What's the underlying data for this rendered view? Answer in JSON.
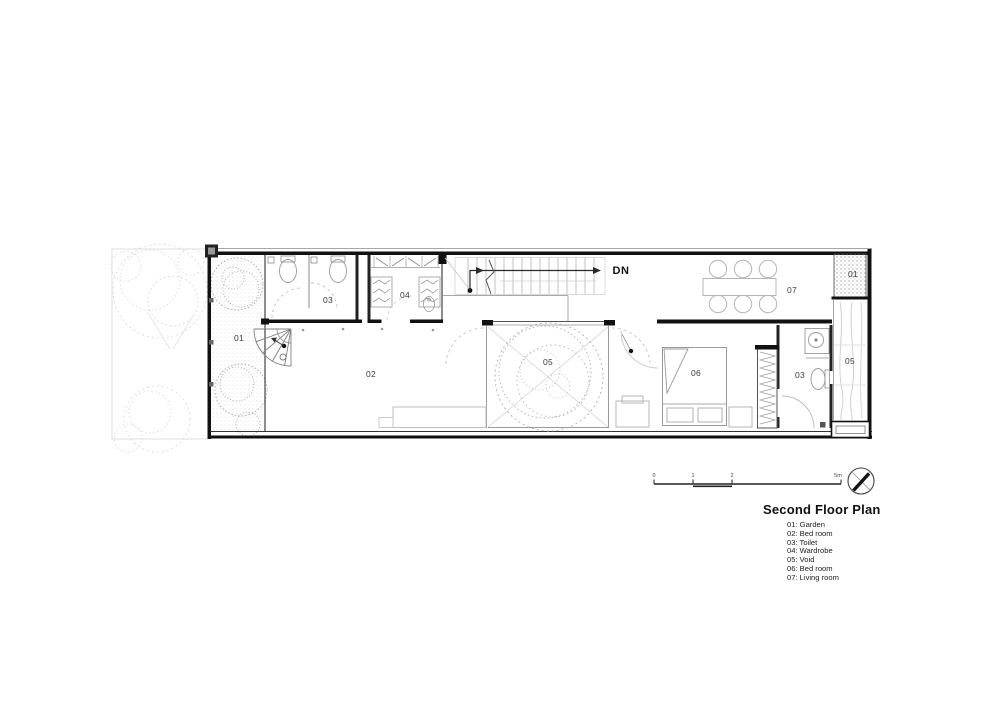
{
  "plan": {
    "dn_label": "DN",
    "labels": {
      "garden_left": "01",
      "bedroom_main": "02",
      "toilet_left": "03",
      "wardrobe": "04",
      "void_center": "05",
      "bedroom_second": "06",
      "toilet_right": "03",
      "living_room": "07",
      "garden_right": "01",
      "void_right": "05"
    }
  },
  "scale_bar": {
    "ticks": [
      "0",
      "1",
      "2",
      "5m"
    ]
  },
  "icons": {
    "compass": "north-arrow-compass"
  },
  "title_block": {
    "title": "Second Floor Plan",
    "legend": [
      "01: Garden",
      "02: Bed room",
      "03: Toilet",
      "04: Wardrobe",
      "05: Void",
      "06: Bed room",
      "07: Living room"
    ]
  }
}
